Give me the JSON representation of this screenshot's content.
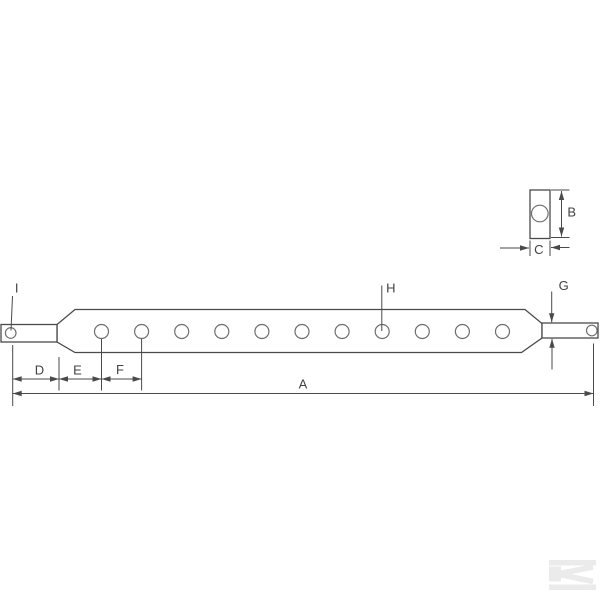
{
  "figure": {
    "kind": "technical-line-drawing",
    "subject": "drawbar with hole row, end pins and cross-section end view",
    "background": "#ffffff"
  },
  "colors": {
    "outline": "#4a4a4a",
    "hole_stroke": "#6e6e6e",
    "dim_stroke": "#4a4a4a",
    "text": "#424242",
    "watermark": "#ebebeb"
  },
  "labels": [
    {
      "id": "A",
      "text": "A",
      "x": 303,
      "y": 388.5
    },
    {
      "id": "B",
      "text": "B",
      "x": 571.7,
      "y": 216.5
    },
    {
      "id": "C",
      "text": "C",
      "x": 538.8,
      "y": 254
    },
    {
      "id": "D",
      "text": "D",
      "x": 39.5,
      "y": 374.5
    },
    {
      "id": "E",
      "text": "E",
      "x": 77.5,
      "y": 374.5
    },
    {
      "id": "F",
      "text": "F",
      "x": 120,
      "y": 374
    },
    {
      "id": "G",
      "text": "G",
      "x": 563.7,
      "y": 290
    },
    {
      "id": "H",
      "text": "H",
      "x": 390.8,
      "y": 292.5
    },
    {
      "id": "I",
      "text": "I",
      "x": 16.7,
      "y": 292.5
    }
  ],
  "geometry": {
    "bar_polygon": "75,309.5 525,309.5 542,323.5 542,338 521.5,352.5 75,352.5 57,342 57,324.5",
    "rects": [
      {
        "id": "left-pin",
        "x": 1,
        "y": 324.5,
        "w": 56,
        "h": 17.5
      },
      {
        "id": "right-pin",
        "x": 542,
        "y": 323,
        "w": 56,
        "h": 15
      },
      {
        "id": "end-view-body",
        "x": 530,
        "y": 190,
        "w": 20,
        "h": 48.5
      }
    ],
    "bar_holes": {
      "y": 331.5,
      "r": 7,
      "xs": [
        101.5,
        141.6,
        181.7,
        221.8,
        261.9,
        302.0,
        342.1,
        382.2,
        422.3,
        462.4,
        502.5
      ]
    },
    "pin_holes": [
      {
        "id": "left-pin-hole",
        "x": 10.7,
        "y": 333,
        "r": 5.3
      },
      {
        "id": "right-pin-hole",
        "x": 591.8,
        "y": 330.5,
        "r": 5.3
      }
    ],
    "end_view_hole": {
      "x": 539.8,
      "y": 213.5,
      "r": 8.3
    },
    "plain_lines": [
      {
        "id": "leader-I",
        "x1": 12.5,
        "y1": 296,
        "x2": 11,
        "y2": 330.5
      },
      {
        "id": "leader-H",
        "x1": 381.8,
        "y1": 285.5,
        "x2": 381.8,
        "y2": 331
      },
      {
        "id": "ext-B-top",
        "x1": 551,
        "y1": 190,
        "x2": 569.5,
        "y2": 190
      },
      {
        "id": "ext-B-bottom",
        "x1": 551,
        "y1": 237.5,
        "x2": 569.5,
        "y2": 237.5
      },
      {
        "id": "ext-C-left",
        "x1": 530,
        "y1": 240.5,
        "x2": 530,
        "y2": 256
      },
      {
        "id": "ext-C-right",
        "x1": 550,
        "y1": 240.5,
        "x2": 550,
        "y2": 256
      },
      {
        "id": "ext-A-left",
        "x1": 12.7,
        "y1": 345,
        "x2": 12.7,
        "y2": 406
      },
      {
        "id": "ext-taper-start",
        "x1": 59,
        "y1": 357,
        "x2": 59,
        "y2": 390.5
      },
      {
        "id": "ext-hole-1",
        "x1": 101.5,
        "y1": 339,
        "x2": 101.5,
        "y2": 390.5
      },
      {
        "id": "ext-hole-2",
        "x1": 141.6,
        "y1": 339,
        "x2": 141.6,
        "y2": 390.5
      },
      {
        "id": "ext-A-right",
        "x1": 593.5,
        "y1": 343.5,
        "x2": 593.5,
        "y2": 406
      }
    ],
    "dim_lines": [
      {
        "id": "dim-B",
        "x1": 561.5,
        "y1": 191,
        "x2": 561.5,
        "y2": 236.5,
        "heads": "both"
      },
      {
        "id": "dim-C-left",
        "x1": 500,
        "y1": 248,
        "x2": 529,
        "y2": 248,
        "heads": "end"
      },
      {
        "id": "dim-C-right",
        "x1": 569.5,
        "y1": 247.5,
        "x2": 551,
        "y2": 247.5,
        "heads": "end"
      },
      {
        "id": "dim-G-top",
        "x1": 551.7,
        "y1": 291.5,
        "x2": 551.7,
        "y2": 322.3,
        "heads": "end"
      },
      {
        "id": "dim-G-bottom",
        "x1": 552,
        "y1": 369.5,
        "x2": 552,
        "y2": 338.8,
        "heads": "end"
      },
      {
        "id": "dim-D",
        "x1": 12.7,
        "y1": 379,
        "x2": 59,
        "y2": 379,
        "heads": "both"
      },
      {
        "id": "dim-E",
        "x1": 59,
        "y1": 379,
        "x2": 101.5,
        "y2": 379,
        "heads": "both"
      },
      {
        "id": "dim-F",
        "x1": 101.5,
        "y1": 379,
        "x2": 141.6,
        "y2": 379,
        "heads": "both"
      },
      {
        "id": "dim-A",
        "x1": 12.7,
        "y1": 393.5,
        "x2": 593.5,
        "y2": 393.5,
        "heads": "both"
      }
    ]
  },
  "watermark": {
    "name": "kramp-k-logo",
    "bars": [
      {
        "x": 549,
        "y": 560,
        "w": 47,
        "h": 5.5
      },
      {
        "x": 549,
        "y": 584.5,
        "w": 47,
        "h": 5.5
      }
    ],
    "stem": {
      "x": 549,
      "y": 566.5,
      "w": 12,
      "h": 15
    },
    "arms": [
      {
        "x1": 560,
        "y1": 573.5,
        "x2": 593,
        "y2": 567
      },
      {
        "x1": 560,
        "y1": 574.5,
        "x2": 593,
        "y2": 581.5
      }
    ],
    "arm_width": 5.5
  }
}
